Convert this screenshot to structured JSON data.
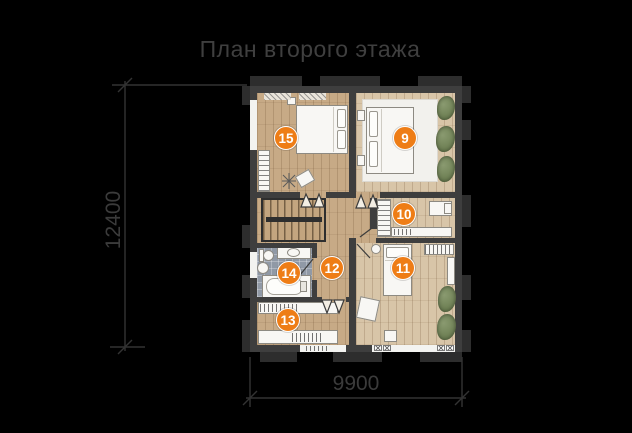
{
  "title": "План второго этажа",
  "dimensions": {
    "height_label": "12400",
    "width_label": "9900"
  },
  "markers": [
    {
      "label": "9"
    },
    {
      "label": "10"
    },
    {
      "label": "11"
    },
    {
      "label": "12"
    },
    {
      "label": "13"
    },
    {
      "label": "14"
    },
    {
      "label": "15"
    }
  ],
  "colors": {
    "background": "#000000",
    "title_text": "#3f3f3f",
    "dimension_text": "#3b3b3b",
    "marker_orange": "#ee7d16",
    "wall_gray": "#3e3e3e",
    "pilaster_gray": "#2d2d2d",
    "wood_floor": "#c7aa86",
    "wood_floor_light": "#d8c5a8",
    "bathroom_tile": "#9099a6",
    "plant_green": "#6c7e52",
    "fixture_white": "#f8f7f4"
  }
}
